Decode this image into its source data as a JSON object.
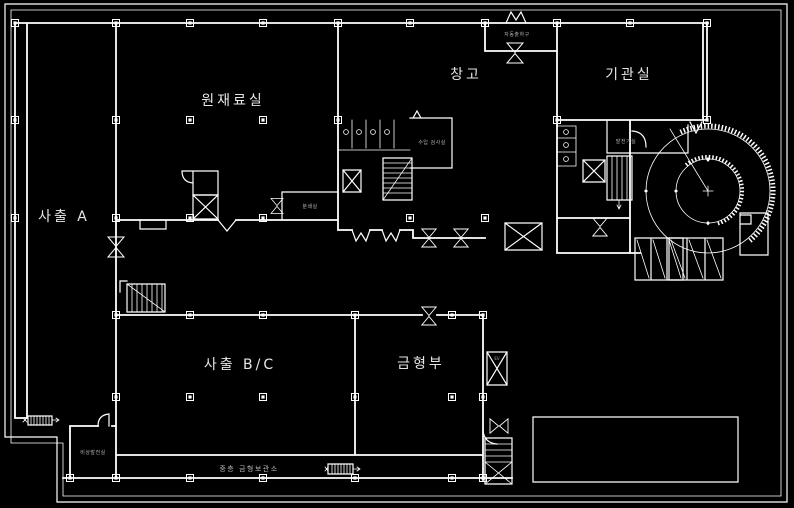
{
  "canvas": {
    "width": 794,
    "height": 508,
    "background": "#000000",
    "line_color": "#ffffff",
    "text_color": "#e6e6e6",
    "dim_text_color": "#b4b4b4"
  },
  "rooms": {
    "sachul_a": "사출 A",
    "raw_material": "원재료실",
    "warehouse": "창고",
    "engine_room": "기관실",
    "sachul_bc": "사출 B/C",
    "mold_dept": "금형부"
  },
  "annotations": {
    "auto_shipping_exit": "자동출하구",
    "incoming_inspection": "수입 검사실",
    "generator_room": "발전기실",
    "crusher_room": "분쇄실",
    "mezzanine_mold_storage": "중층 금형보관소",
    "corner_utility_room": "비상발전실",
    "freight_elevator": "EV"
  }
}
